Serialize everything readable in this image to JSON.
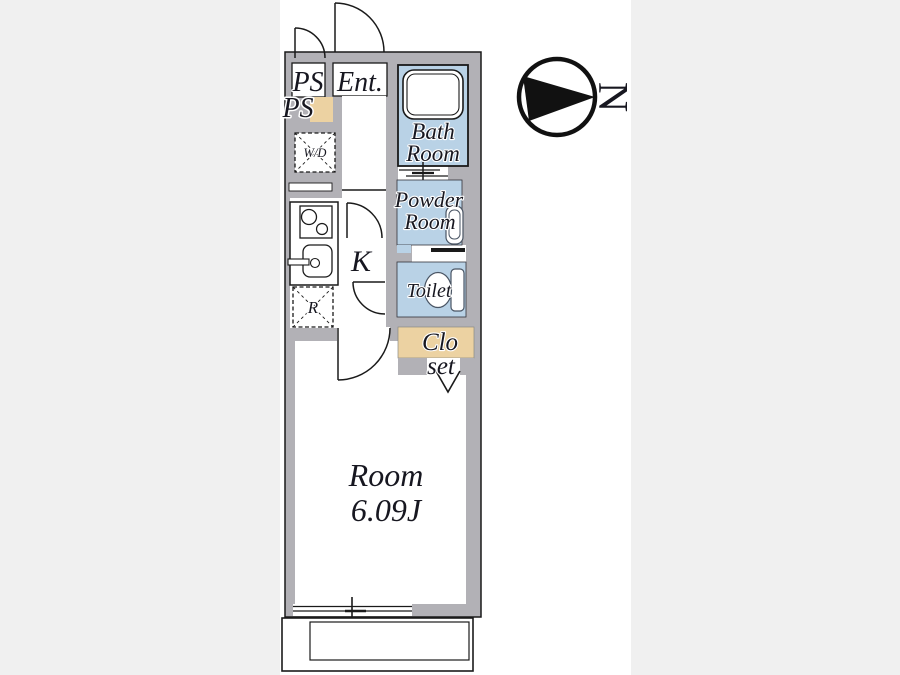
{
  "labels": {
    "ps_top": "PS",
    "entrance": "Ent.",
    "ps_side": "PS",
    "washer_dryer": "W/D",
    "bath_line1": "Bath",
    "bath_line2": "Room",
    "powder_line1": "Powder",
    "powder_line2": "Room",
    "kitchen": "K",
    "toilet": "Toilet",
    "refrigerator": "R",
    "closet_line1": "Clo",
    "closet_line2": "set",
    "room_line1": "Room",
    "room_line2": "6.09J"
  },
  "compass": {
    "north_label": "N"
  },
  "colors": {
    "background_band": "#f0f0f0",
    "wall_gray": "#b2b1b6",
    "wet_area_blue": "#b9d2e6",
    "closet_tan": "#ecd2a2",
    "line_black": "#1a1a1a",
    "label_ink": "#171720",
    "closet_ink": "#3b3830"
  }
}
